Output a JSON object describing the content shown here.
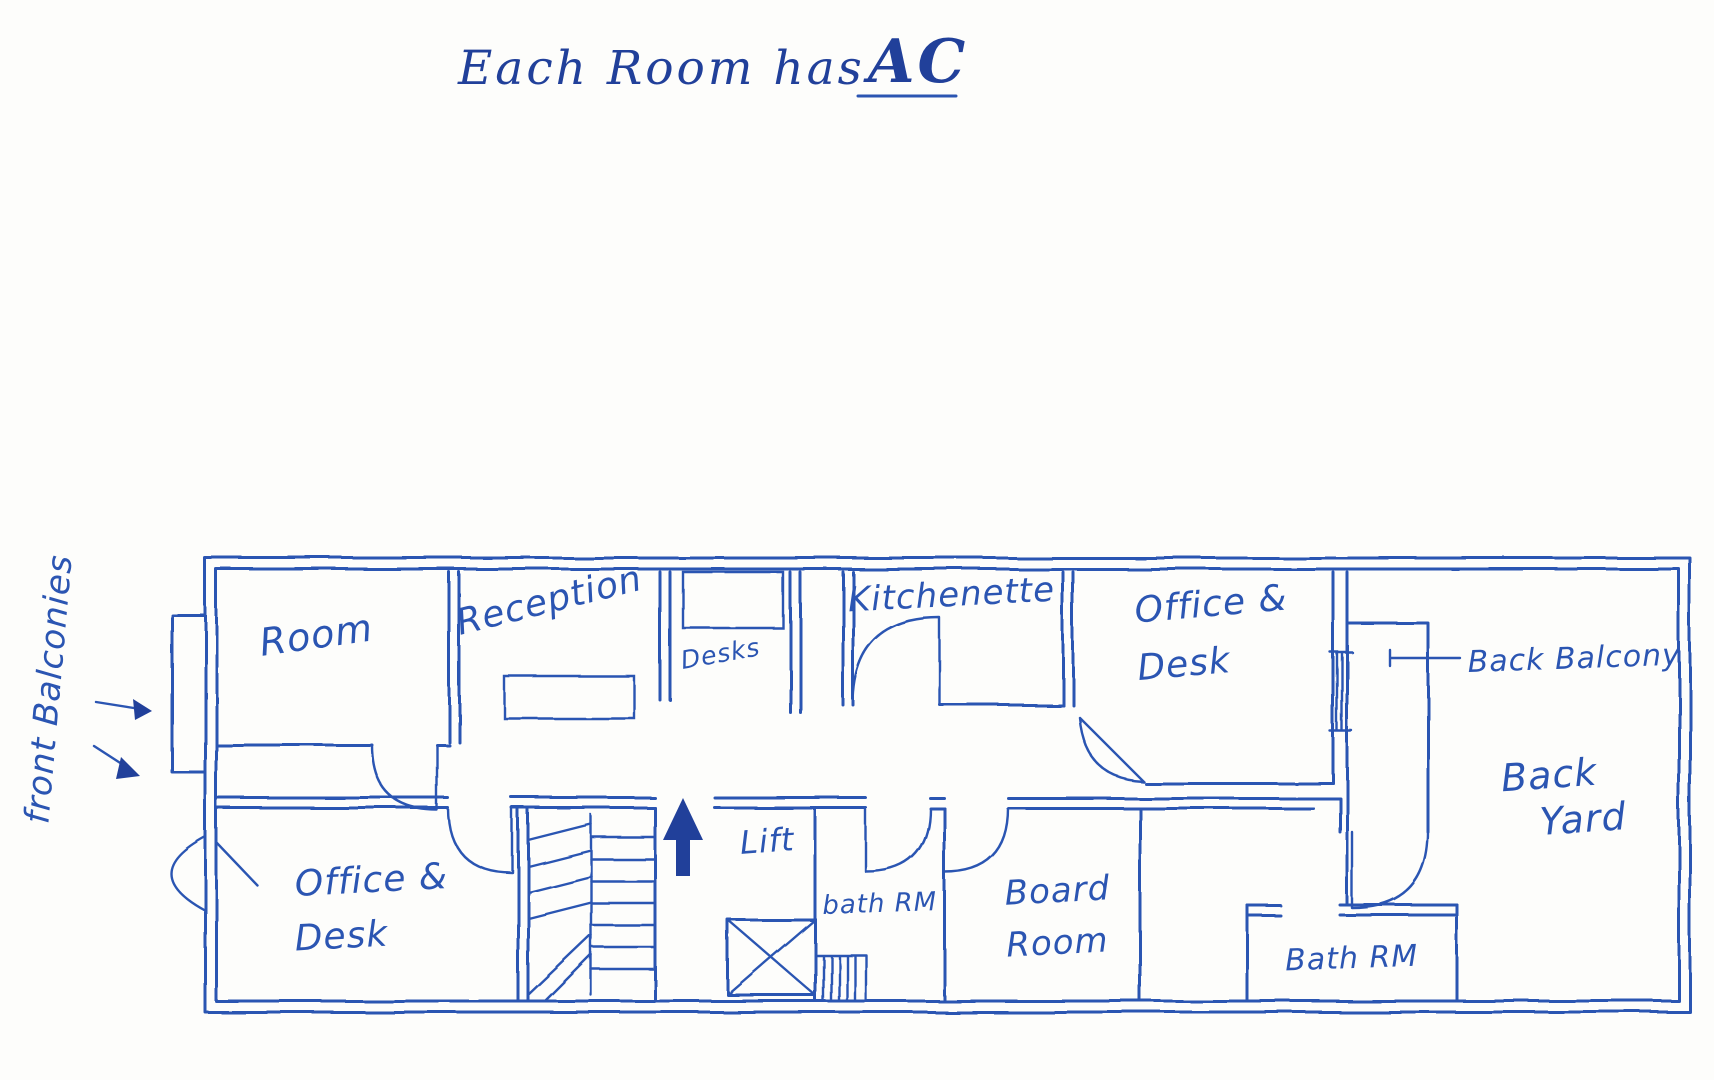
{
  "title": {
    "text": "Each Room has",
    "emphasis": "AC"
  },
  "side_note": "front Balconies",
  "callouts": {
    "back_balcony": "Back Balcony"
  },
  "rooms": {
    "room": "Room",
    "reception": "Reception",
    "desks": "Desks",
    "kitchenette": "Kitchenette",
    "office_desk_top_1": "Office &",
    "office_desk_top_2": "Desk",
    "office_desk_bottom_1": "Office &",
    "office_desk_bottom_2": "Desk",
    "lift": "Lift",
    "bath_rm_small": "bath RM",
    "board_room_1": "Board",
    "board_room_2": "Room",
    "bath_rm_large": "Bath RM",
    "back_yard_1": "Back",
    "back_yard_2": "Yard"
  },
  "icons": {
    "up_arrow": "up-direction-arrow",
    "balcony_arrows": "pointer-arrows"
  },
  "colors": {
    "ink": "#2b55b2",
    "ink_dark": "#21409a",
    "paper": "#fdfdfb"
  }
}
